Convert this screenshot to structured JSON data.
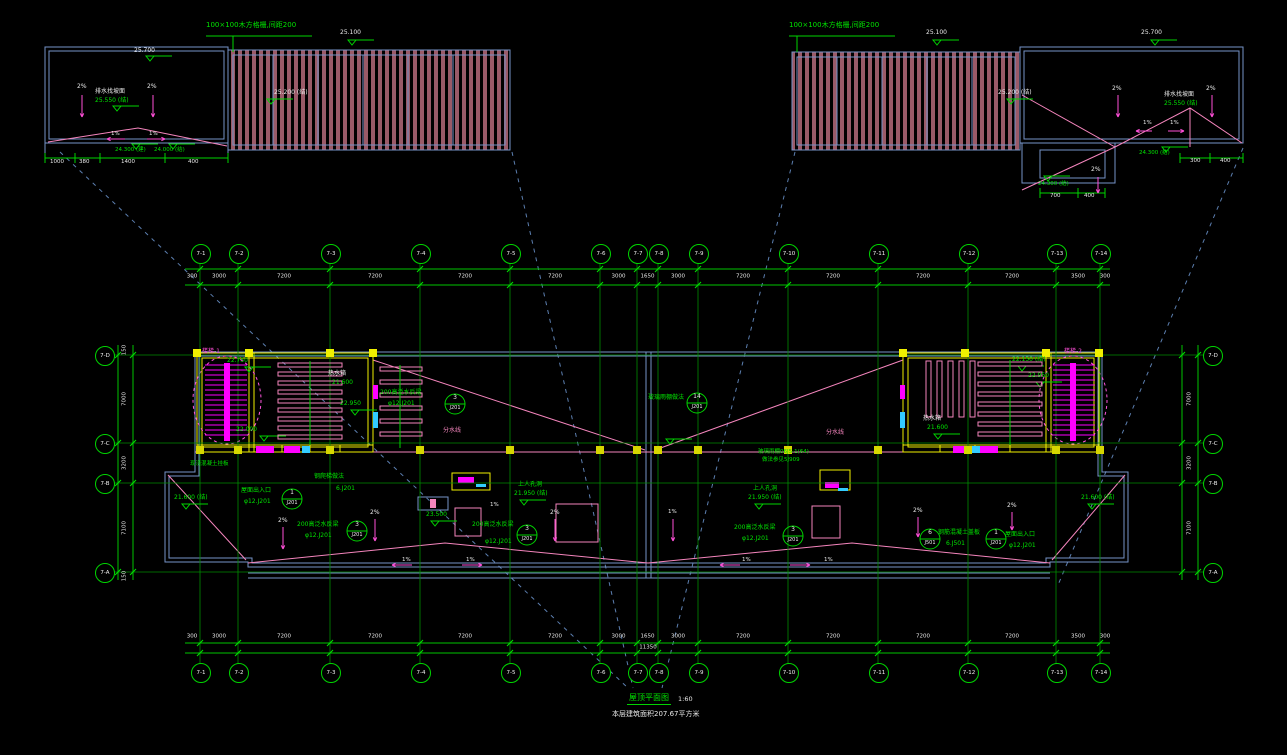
{
  "drawing": {
    "title": "屋顶平面图",
    "scale": "1:60",
    "area_note": "本层建筑面积207.67平方米"
  },
  "pergola_note": "100×100木方格栅,间距200",
  "colors": {
    "background": "#000000",
    "grid_green": "#008c00",
    "note_green": "#00e400",
    "dim_white": "#e8e8e8",
    "outline_blue": "#7693c8",
    "leader_blue": "#5c7fb0",
    "wall_yellow": "#f0f000",
    "stair_magenta": "#ff00ff",
    "slope_pink": "#f585bd",
    "hatch_maroon": "#9a5a68",
    "cyan": "#33ccff"
  },
  "axes": {
    "cols": {
      "labels": [
        "7-1",
        "7-2",
        "7-3",
        "7-4",
        "7-5",
        "7-6",
        "7-7",
        "7-8",
        "7-9",
        "7-10",
        "7-11",
        "7-12",
        "7-13",
        "7-14"
      ],
      "x": [
        200,
        238,
        330,
        420,
        510,
        600,
        637,
        658,
        698,
        788,
        878,
        968,
        1056,
        1100
      ]
    },
    "rows": {
      "labels": [
        "7-D",
        "7-C",
        "7-B",
        "7-A"
      ],
      "y": [
        355,
        443,
        483,
        572
      ]
    }
  },
  "dimensions": {
    "top_gaps": [
      "3000",
      "7200",
      "7200",
      "7200",
      "7200",
      "3000",
      "1650",
      "3000",
      "7200",
      "7200",
      "7200",
      "7200",
      "3500"
    ],
    "bottom_gaps": [
      "3000",
      "7200",
      "7200",
      "7200",
      "7200",
      "3000",
      "1650",
      "3000",
      "7200",
      "7200",
      "7200",
      "7200",
      "3500"
    ],
    "side_gaps": [
      "7000",
      "3200",
      "7100"
    ],
    "edge_top": "300",
    "edge_side": "150",
    "subtotal": "11350",
    "detail_left": [
      "1000",
      "380",
      "1400",
      "400"
    ],
    "detail_right_a": [
      "300",
      "400"
    ],
    "detail_right_b": [
      "700",
      "400"
    ]
  },
  "callouts": [
    {
      "x": 455,
      "y": 404,
      "num": "3",
      "ref": "J201"
    },
    {
      "x": 357,
      "y": 531,
      "num": "3",
      "ref": "J201"
    },
    {
      "x": 527,
      "y": 535,
      "num": "3",
      "ref": "J201"
    },
    {
      "x": 793,
      "y": 536,
      "num": "3",
      "ref": "J201"
    },
    {
      "x": 292,
      "y": 499,
      "num": "1",
      "ref": "J201"
    },
    {
      "x": 996,
      "y": 539,
      "num": "1",
      "ref": "J201"
    },
    {
      "x": 930,
      "y": 539,
      "num": "6",
      "ref": "J501"
    },
    {
      "x": 697,
      "y": 403,
      "num": "14",
      "ref": "J201"
    }
  ],
  "labels": [
    [
      "25.100",
      340,
      30,
      "w",
      6
    ],
    [
      "25.700",
      134,
      48,
      "w",
      6
    ],
    [
      "2%",
      77,
      84,
      "w",
      6
    ],
    [
      "2%",
      147,
      84,
      "w",
      6
    ],
    [
      "排水找坡面",
      95,
      89,
      "w",
      6
    ],
    [
      "25.550 (结)",
      95,
      98,
      "g",
      6
    ],
    [
      "25.200 (结)",
      274,
      90,
      "w",
      6
    ],
    [
      "1%",
      111,
      132,
      "w",
      5.5
    ],
    [
      "1%",
      149,
      132,
      "w",
      5.5
    ],
    [
      "24.300 (建)",
      115,
      148,
      "g",
      5.5
    ],
    [
      "24.000 (结)",
      154,
      148,
      "g",
      5.5
    ],
    [
      "1000",
      50,
      160,
      "w",
      5.5
    ],
    [
      "380",
      79,
      160,
      "w",
      5.5
    ],
    [
      "1400",
      121,
      160,
      "w",
      5.5
    ],
    [
      "400",
      188,
      160,
      "w",
      5.5
    ],
    [
      "25.100",
      926,
      30,
      "w",
      6
    ],
    [
      "25.200 (结)",
      998,
      90,
      "w",
      6
    ],
    [
      "25.700",
      1141,
      30,
      "w",
      6
    ],
    [
      "2%",
      1112,
      86,
      "w",
      6
    ],
    [
      "2%",
      1206,
      86,
      "w",
      6
    ],
    [
      "排水找坡面",
      1164,
      92,
      "w",
      6
    ],
    [
      "25.550 (结)",
      1164,
      101,
      "g",
      6
    ],
    [
      "1%",
      1143,
      121,
      "w",
      5.5
    ],
    [
      "1%",
      1170,
      121,
      "w",
      5.5
    ],
    [
      "2%",
      1091,
      167,
      "w",
      6
    ],
    [
      "24.300 (结)",
      1139,
      151,
      "g",
      5.5
    ],
    [
      "300",
      1190,
      159,
      "w",
      5.5
    ],
    [
      "400",
      1220,
      159,
      "w",
      5.5
    ],
    [
      "700",
      1050,
      194,
      "w",
      5.5
    ],
    [
      "400",
      1084,
      194,
      "w",
      5.5
    ],
    [
      "24.300 (结)",
      1038,
      182,
      "g",
      5.5
    ],
    [
      "楼梯-1",
      202,
      349,
      "m",
      6
    ],
    [
      "楼梯-2",
      1064,
      349,
      "m",
      6
    ],
    [
      "22.750",
      227,
      358,
      "g",
      6
    ],
    [
      "热水箱",
      328,
      371,
      "w",
      6
    ],
    [
      "21.600",
      332,
      380,
      "g",
      6
    ],
    [
      "22.950",
      340,
      401,
      "g",
      6
    ],
    [
      "22.000",
      236,
      427,
      "g",
      6
    ],
    [
      "22.150 (结)",
      1012,
      357,
      "g",
      6
    ],
    [
      "22.950",
      1028,
      373,
      "g",
      6
    ],
    [
      "热水箱",
      923,
      416,
      "w",
      6
    ],
    [
      "21.600",
      927,
      425,
      "g",
      6
    ],
    [
      "200高泛水反梁",
      380,
      390,
      "g",
      6
    ],
    [
      "φ12.J201",
      388,
      401,
      "g",
      6
    ],
    [
      "分水线",
      443,
      428,
      "p",
      6
    ],
    [
      "分水线",
      826,
      430,
      "p",
      6
    ],
    [
      "玻璃雨棚做法",
      648,
      395,
      "g",
      6
    ],
    [
      "上人孔洞",
      518,
      482,
      "g",
      6
    ],
    [
      "21.950 (结)",
      514,
      491,
      "g",
      6
    ],
    [
      "上人孔洞",
      753,
      486,
      "g",
      6
    ],
    [
      "21.950 (结)",
      748,
      495,
      "g",
      6
    ],
    [
      "23.500",
      426,
      512,
      "g",
      6
    ],
    [
      "钢爬梯做法",
      314,
      474,
      "g",
      6
    ],
    [
      "6.J201",
      336,
      486,
      "g",
      6
    ],
    [
      "现浇混凝土挂板",
      190,
      462,
      "g",
      5.5
    ],
    [
      "屋面出入口",
      241,
      488,
      "g",
      6
    ],
    [
      "φ12.J201",
      244,
      499,
      "g",
      6
    ],
    [
      "200高泛水反梁",
      297,
      522,
      "g",
      6
    ],
    [
      "φ12.J201",
      305,
      533,
      "g",
      6
    ],
    [
      "200高泛水反梁",
      472,
      522,
      "g",
      6
    ],
    [
      "φ12.J201",
      485,
      539,
      "g",
      6
    ],
    [
      "200高泛水反梁",
      734,
      525,
      "g",
      6
    ],
    [
      "φ12.J201",
      742,
      536,
      "g",
      6
    ],
    [
      "钢筋混凝土盖板",
      938,
      530,
      "g",
      6
    ],
    [
      "6.J501",
      946,
      541,
      "g",
      6
    ],
    [
      "屋面出入口",
      1005,
      532,
      "g",
      6
    ],
    [
      "φ12.J201",
      1009,
      543,
      "g",
      6
    ],
    [
      "21.600 (结)",
      174,
      495,
      "g",
      6
    ],
    [
      "21.600 (结)",
      1081,
      495,
      "g",
      6
    ],
    [
      "玻璃雨棚06J5-1(64)",
      758,
      450,
      "g",
      5.5
    ],
    [
      "做法参见5J909",
      762,
      458,
      "g",
      5.5
    ],
    [
      "2%",
      278,
      518,
      "w",
      6
    ],
    [
      "2%",
      370,
      510,
      "w",
      6
    ],
    [
      "1%",
      490,
      503,
      "w",
      5.5
    ],
    [
      "2%",
      550,
      510,
      "w",
      6
    ],
    [
      "1%",
      668,
      510,
      "w",
      5.5
    ],
    [
      "2%",
      913,
      508,
      "w",
      6
    ],
    [
      "2%",
      1007,
      503,
      "w",
      6
    ],
    [
      "1%",
      402,
      558,
      "w",
      5.5
    ],
    [
      "1%",
      466,
      558,
      "w",
      5.5
    ],
    [
      "1%",
      742,
      558,
      "w",
      5.5
    ],
    [
      "1%",
      824,
      558,
      "w",
      5.5
    ]
  ]
}
